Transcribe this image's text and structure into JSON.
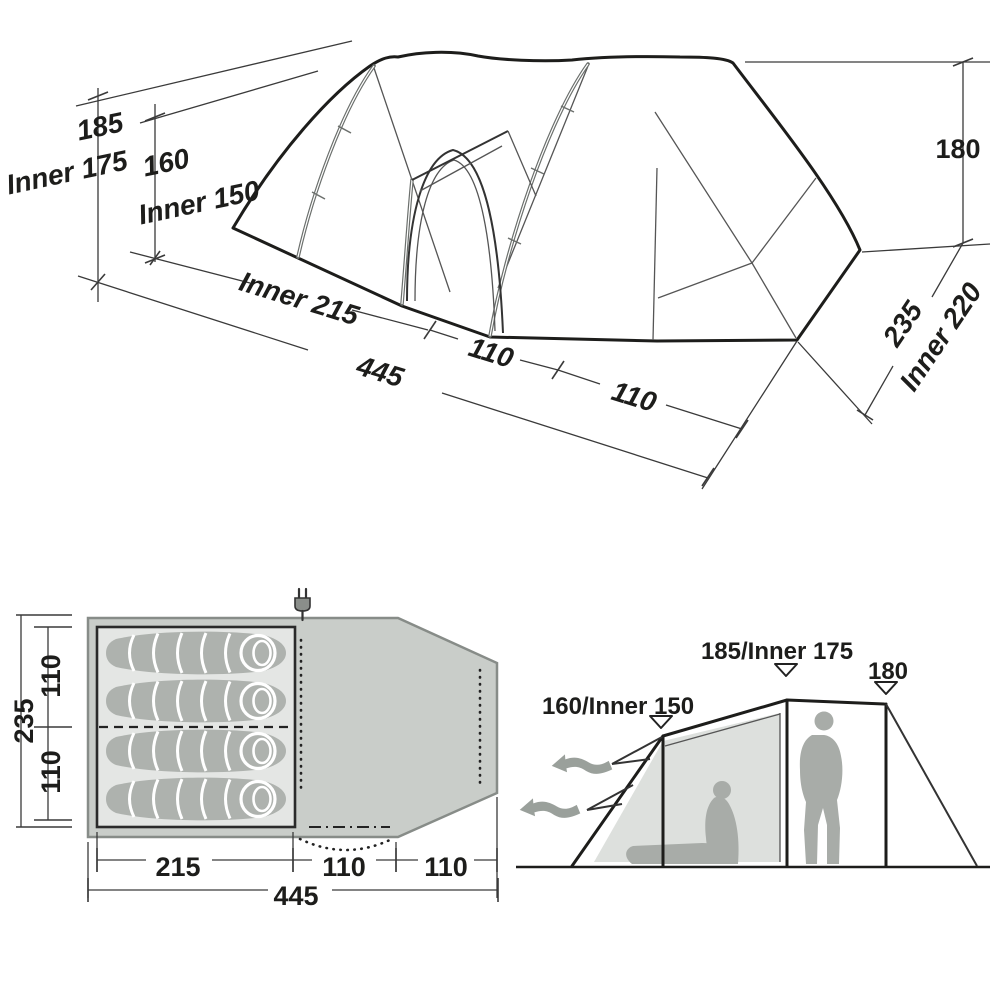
{
  "colors": {
    "ink": "#1d1d1b",
    "dim_line": "#3a3a3a",
    "seam": "#555555",
    "pole": "#6b6f6c",
    "plan_fill": "#c9cdc9",
    "plan_stroke": "#878c88",
    "cabin_fill": "#e4e6e4",
    "sleeping_bag": "#aeb2ae",
    "mesh_panel": "#dde0dd",
    "silhouette": "#a8aca8",
    "airflow_arrow": "#9aa09b"
  },
  "top_view": {
    "labels": {
      "height_main": "185",
      "height_main_inner": "Inner 175",
      "height_porch": "160",
      "height_porch_inner": "Inner 150",
      "length_inner": "Inner 215",
      "length_total": "445",
      "length_seg1": "110",
      "length_seg2": "110",
      "height_rear": "180",
      "width_total": "235",
      "width_inner": "Inner 220"
    }
  },
  "floor_plan": {
    "sleeping_bag_count": 4,
    "labels": {
      "width_total": "235",
      "width_top": "110",
      "width_bottom": "110",
      "length_inner": "215",
      "length_seg1": "110",
      "length_seg2": "110",
      "length_total": "445"
    }
  },
  "elevation": {
    "labels": {
      "porch_height": "160/Inner 150",
      "main_height": "185/Inner 175",
      "rear_height": "180"
    }
  }
}
